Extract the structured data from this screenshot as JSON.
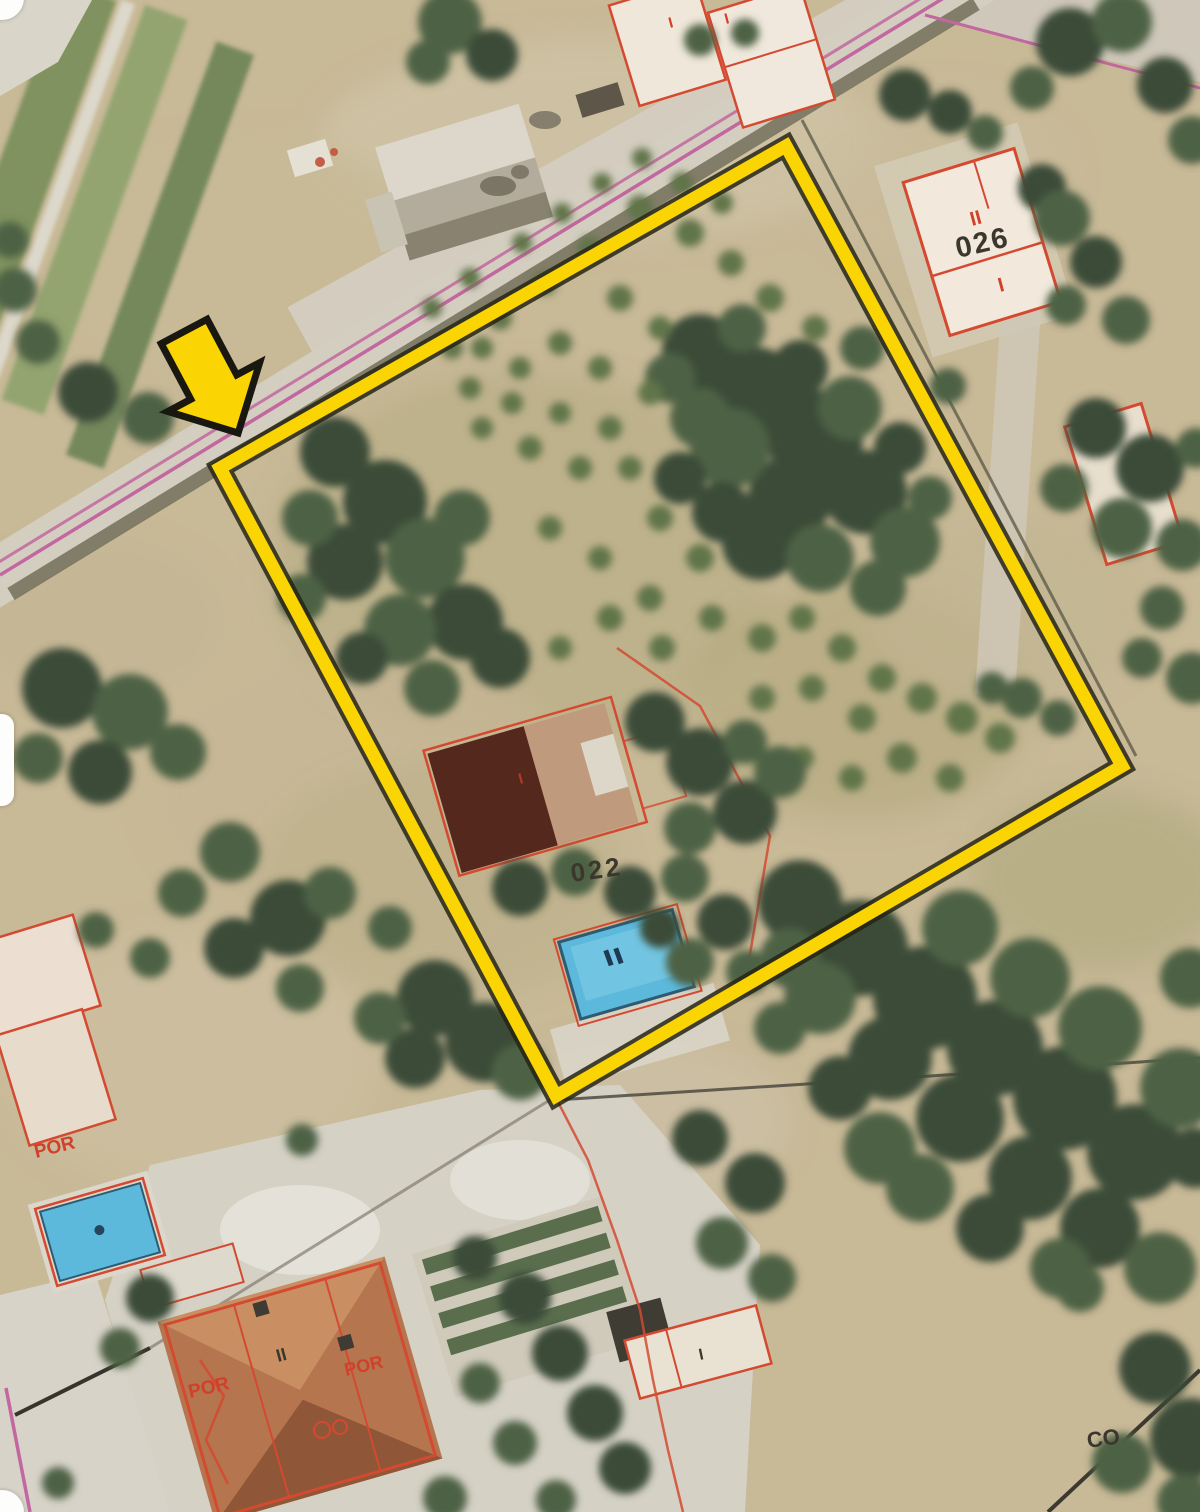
{
  "map": {
    "type": "aerial-cadastral-plot-map",
    "description": "Satellite view with cadastral overlay, plot highlighted in yellow with pointer arrow",
    "colors": {
      "boundary_yellow": "#FBD403",
      "boundary_outline": "#262414",
      "cadastral_red": "#D44A31",
      "road_pink": "#C2679F",
      "pool_blue": "#5CB9DB",
      "label_dark": "#3B372C",
      "label_red": "#D0402A",
      "dirt": "#C8B997",
      "tree_tones": [
        "#3A4C38",
        "#4E6245",
        "#607449"
      ]
    },
    "labels": {
      "parcel_026_storeys": "II",
      "parcel_026_number": "026",
      "parcel_026_annex": "I",
      "parcel_022_number": "022",
      "label_co": "CO",
      "house_sw_storeys": "II",
      "house_sw_porch_left": "POR",
      "house_sw_porch_right": "POR",
      "annex_w_porch": "POR",
      "top_building_mark_1": "I",
      "top_building_mark_2": "I",
      "south_building_mark": "I",
      "main_house_mark": "I"
    },
    "ground_patches": [
      [
        600,
        140,
        280,
        100,
        "#CEC2A4",
        0.9
      ],
      [
        250,
        260,
        190,
        120,
        "#C8BA97",
        0.9
      ],
      [
        520,
        560,
        250,
        190,
        "#B3AB82",
        0.5
      ],
      [
        860,
        700,
        170,
        120,
        "#ACA577",
        0.45
      ],
      [
        360,
        790,
        210,
        140,
        "#C6B795",
        0.7
      ],
      [
        190,
        1060,
        190,
        130,
        "#CCBF9F",
        0.75
      ],
      [
        640,
        1120,
        150,
        80,
        "#CDC1A6",
        0.7
      ],
      [
        1010,
        610,
        140,
        90,
        "#C1B593",
        0.6
      ],
      [
        440,
        880,
        180,
        120,
        "#B7AE86",
        0.45
      ],
      [
        940,
        180,
        130,
        90,
        "#C9BC9C",
        0.6
      ],
      [
        100,
        620,
        120,
        80,
        "#C3B694",
        0.6
      ],
      [
        1100,
        880,
        130,
        90,
        "#9FA173",
        0.4
      ],
      [
        70,
        1440,
        90,
        70,
        "#D5D1C5",
        0.8
      ]
    ],
    "vegetation": [
      [
        450,
        22,
        32,
        1
      ],
      [
        492,
        55,
        26,
        0
      ],
      [
        428,
        62,
        22,
        1
      ],
      [
        700,
        40,
        16,
        1
      ],
      [
        745,
        33,
        14,
        1
      ],
      [
        905,
        95,
        26,
        0
      ],
      [
        950,
        112,
        22,
        0
      ],
      [
        985,
        133,
        18,
        1
      ],
      [
        1070,
        42,
        34,
        0
      ],
      [
        1122,
        22,
        30,
        1
      ],
      [
        1165,
        85,
        28,
        0
      ],
      [
        1192,
        140,
        24,
        1
      ],
      [
        1032,
        88,
        22,
        1
      ],
      [
        1042,
        188,
        24,
        0
      ],
      [
        1062,
        218,
        28,
        1
      ],
      [
        1096,
        262,
        26,
        0
      ],
      [
        1126,
        320,
        24,
        1
      ],
      [
        1066,
        305,
        20,
        1
      ],
      [
        948,
        386,
        18,
        1
      ],
      [
        1096,
        428,
        30,
        0
      ],
      [
        1150,
        468,
        34,
        0
      ],
      [
        1122,
        528,
        30,
        1
      ],
      [
        1182,
        545,
        26,
        1
      ],
      [
        1064,
        488,
        24,
        1
      ],
      [
        1196,
        448,
        20,
        1
      ],
      [
        1162,
        608,
        22,
        1
      ],
      [
        1192,
        678,
        26,
        1
      ],
      [
        1142,
        658,
        20,
        1
      ],
      [
        88,
        392,
        30,
        0
      ],
      [
        148,
        418,
        26,
        1
      ],
      [
        38,
        342,
        22,
        1
      ],
      [
        15,
        290,
        22,
        1
      ],
      [
        10,
        240,
        18,
        1
      ],
      [
        62,
        688,
        40,
        0
      ],
      [
        130,
        712,
        38,
        1
      ],
      [
        100,
        772,
        32,
        0
      ],
      [
        178,
        752,
        28,
        1
      ],
      [
        38,
        758,
        25,
        1
      ],
      [
        230,
        852,
        30,
        1
      ],
      [
        288,
        918,
        38,
        0
      ],
      [
        234,
        948,
        30,
        0
      ],
      [
        330,
        893,
        26,
        1
      ],
      [
        182,
        893,
        24,
        1
      ],
      [
        300,
        988,
        24,
        1
      ],
      [
        150,
        958,
        20,
        1
      ],
      [
        390,
        928,
        22,
        1
      ],
      [
        96,
        930,
        18,
        1
      ],
      [
        335,
        452,
        35,
        0
      ],
      [
        385,
        502,
        42,
        0
      ],
      [
        345,
        562,
        38,
        0
      ],
      [
        425,
        558,
        40,
        1
      ],
      [
        465,
        622,
        38,
        0
      ],
      [
        400,
        630,
        36,
        1
      ],
      [
        310,
        518,
        28,
        1
      ],
      [
        462,
        518,
        28,
        1
      ],
      [
        500,
        658,
        30,
        0
      ],
      [
        432,
        688,
        28,
        1
      ],
      [
        362,
        658,
        26,
        0
      ],
      [
        302,
        598,
        24,
        1
      ],
      [
        700,
        352,
        38,
        0
      ],
      [
        755,
        392,
        45,
        0
      ],
      [
        815,
        438,
        48,
        0
      ],
      [
        865,
        492,
        42,
        0
      ],
      [
        905,
        542,
        35,
        1
      ],
      [
        790,
        498,
        42,
        0
      ],
      [
        730,
        448,
        40,
        1
      ],
      [
        850,
        408,
        32,
        1
      ],
      [
        700,
        418,
        30,
        1
      ],
      [
        760,
        542,
        38,
        0
      ],
      [
        820,
        558,
        34,
        1
      ],
      [
        878,
        588,
        28,
        1
      ],
      [
        722,
        512,
        30,
        0
      ],
      [
        670,
        378,
        25,
        1
      ],
      [
        742,
        328,
        24,
        1
      ],
      [
        800,
        368,
        28,
        0
      ],
      [
        862,
        348,
        22,
        1
      ],
      [
        900,
        448,
        26,
        0
      ],
      [
        930,
        498,
        22,
        1
      ],
      [
        680,
        478,
        26,
        0
      ],
      [
        640,
        208,
        13,
        2
      ],
      [
        690,
        233,
        14,
        2
      ],
      [
        731,
        263,
        13,
        2
      ],
      [
        770,
        298,
        14,
        2
      ],
      [
        815,
        328,
        13,
        2
      ],
      [
        590,
        248,
        12,
        2
      ],
      [
        545,
        283,
        12,
        2
      ],
      [
        500,
        318,
        12,
        2
      ],
      [
        620,
        298,
        13,
        2
      ],
      [
        660,
        328,
        12,
        2
      ],
      [
        560,
        343,
        12,
        2
      ],
      [
        520,
        368,
        11,
        2
      ],
      [
        482,
        348,
        11,
        2
      ],
      [
        600,
        368,
        12,
        2
      ],
      [
        650,
        393,
        12,
        2
      ],
      [
        610,
        428,
        12,
        2
      ],
      [
        560,
        413,
        11,
        2
      ],
      [
        512,
        403,
        11,
        2
      ],
      [
        470,
        388,
        11,
        2
      ],
      [
        530,
        448,
        12,
        2
      ],
      [
        580,
        468,
        12,
        2
      ],
      [
        630,
        468,
        12,
        2
      ],
      [
        482,
        428,
        11,
        2
      ],
      [
        452,
        348,
        11,
        2
      ],
      [
        432,
        308,
        10,
        2
      ],
      [
        470,
        278,
        10,
        2
      ],
      [
        522,
        243,
        10,
        2
      ],
      [
        562,
        213,
        10,
        2
      ],
      [
        602,
        183,
        10,
        2
      ],
      [
        642,
        158,
        10,
        2
      ],
      [
        682,
        183,
        11,
        2
      ],
      [
        722,
        203,
        11,
        2
      ],
      [
        660,
        518,
        13,
        2
      ],
      [
        700,
        558,
        14,
        2
      ],
      [
        650,
        598,
        13,
        2
      ],
      [
        600,
        558,
        12,
        2
      ],
      [
        550,
        528,
        12,
        2
      ],
      [
        610,
        618,
        13,
        2
      ],
      [
        560,
        648,
        12,
        2
      ],
      [
        662,
        648,
        13,
        2
      ],
      [
        712,
        618,
        13,
        2
      ],
      [
        762,
        638,
        14,
        2
      ],
      [
        802,
        618,
        13,
        2
      ],
      [
        842,
        648,
        14,
        2
      ],
      [
        882,
        678,
        14,
        2
      ],
      [
        922,
        698,
        15,
        2
      ],
      [
        962,
        718,
        16,
        2
      ],
      [
        1000,
        738,
        15,
        2
      ],
      [
        862,
        718,
        14,
        2
      ],
      [
        812,
        688,
        13,
        2
      ],
      [
        762,
        698,
        13,
        2
      ],
      [
        902,
        758,
        15,
        2
      ],
      [
        950,
        778,
        14,
        2
      ],
      [
        852,
        778,
        13,
        2
      ],
      [
        802,
        758,
        12,
        2
      ],
      [
        1022,
        698,
        20,
        1
      ],
      [
        1058,
        718,
        18,
        1
      ],
      [
        992,
        688,
        16,
        1
      ],
      [
        655,
        722,
        30,
        0
      ],
      [
        700,
        762,
        34,
        0
      ],
      [
        745,
        812,
        32,
        0
      ],
      [
        690,
        828,
        26,
        1
      ],
      [
        780,
        772,
        26,
        1
      ],
      [
        745,
        742,
        22,
        1
      ],
      [
        520,
        888,
        28,
        0
      ],
      [
        575,
        872,
        24,
        1
      ],
      [
        630,
        892,
        26,
        0
      ],
      [
        685,
        878,
        24,
        1
      ],
      [
        725,
        922,
        28,
        0
      ],
      [
        690,
        962,
        24,
        1
      ],
      [
        748,
        972,
        22,
        1
      ],
      [
        660,
        928,
        20,
        0
      ],
      [
        435,
        998,
        38,
        0
      ],
      [
        485,
        1042,
        40,
        0
      ],
      [
        415,
        1058,
        30,
        0
      ],
      [
        520,
        1072,
        28,
        1
      ],
      [
        380,
        1018,
        26,
        1
      ],
      [
        800,
        902,
        42,
        0
      ],
      [
        860,
        948,
        48,
        0
      ],
      [
        925,
        998,
        52,
        0
      ],
      [
        995,
        1048,
        48,
        0
      ],
      [
        1065,
        1098,
        52,
        0
      ],
      [
        1135,
        1152,
        48,
        0
      ],
      [
        1180,
        1088,
        40,
        1
      ],
      [
        1100,
        1028,
        42,
        1
      ],
      [
        1030,
        978,
        40,
        1
      ],
      [
        960,
        928,
        38,
        1
      ],
      [
        890,
        1058,
        42,
        0
      ],
      [
        960,
        1118,
        44,
        0
      ],
      [
        1030,
        1178,
        42,
        0
      ],
      [
        1100,
        1228,
        40,
        0
      ],
      [
        1160,
        1268,
        36,
        1
      ],
      [
        880,
        1148,
        36,
        1
      ],
      [
        820,
        998,
        36,
        1
      ],
      [
        790,
        958,
        30,
        1
      ],
      [
        840,
        1088,
        32,
        0
      ],
      [
        920,
        1188,
        34,
        1
      ],
      [
        990,
        1228,
        34,
        0
      ],
      [
        1060,
        1268,
        30,
        1
      ],
      [
        780,
        1028,
        26,
        1
      ],
      [
        1190,
        978,
        30,
        1
      ],
      [
        1195,
        1158,
        30,
        0
      ],
      [
        700,
        1138,
        28,
        0
      ],
      [
        755,
        1183,
        30,
        0
      ],
      [
        722,
        1243,
        26,
        1
      ],
      [
        772,
        1278,
        24,
        1
      ],
      [
        1155,
        1368,
        36,
        0
      ],
      [
        1190,
        1438,
        40,
        0
      ],
      [
        1122,
        1463,
        30,
        1
      ],
      [
        1185,
        1502,
        28,
        1
      ],
      [
        1080,
        1288,
        24,
        1
      ],
      [
        475,
        1258,
        22,
        0
      ],
      [
        525,
        1298,
        26,
        0
      ],
      [
        560,
        1353,
        28,
        0
      ],
      [
        595,
        1413,
        28,
        0
      ],
      [
        625,
        1468,
        26,
        0
      ],
      [
        515,
        1443,
        22,
        1
      ],
      [
        480,
        1383,
        20,
        1
      ],
      [
        445,
        1498,
        22,
        1
      ],
      [
        556,
        1500,
        20,
        1
      ],
      [
        150,
        1298,
        24,
        0
      ],
      [
        120,
        1348,
        20,
        1
      ],
      [
        58,
        1483,
        16,
        1
      ],
      [
        302,
        1140,
        16,
        1
      ]
    ]
  }
}
